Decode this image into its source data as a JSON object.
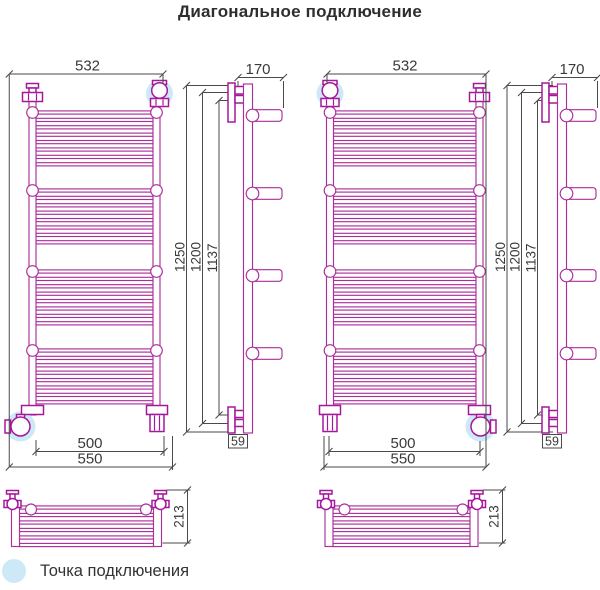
{
  "title": "Диагональное подключение",
  "legend": {
    "label": "Точка подключения"
  },
  "colors": {
    "magenta": "#AB2F9B",
    "fitting": "#A5189A",
    "dim": "#4a4a4a",
    "text": "#3a3a3a",
    "highlight": "#CDE9F8"
  },
  "drawings": {
    "left": {
      "w532": "532",
      "h1250": "1250",
      "h1200": "1200",
      "h1137": "1137",
      "w500": "500",
      "w550": "550",
      "d170": "170",
      "d59": "59",
      "d213": "213"
    },
    "right": {
      "w532": "532",
      "h1250": "1250",
      "h1200": "1200",
      "h1137": "1137",
      "w500": "500",
      "w550": "550",
      "d170": "170",
      "d59": "59",
      "d213": "213"
    }
  }
}
